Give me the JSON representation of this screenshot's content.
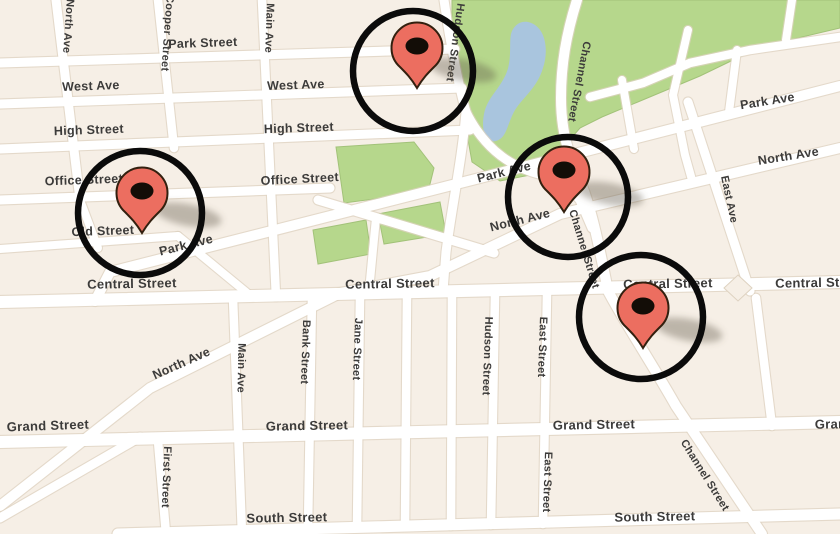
{
  "map": {
    "title": "street map with four highlighted location markers",
    "colors": {
      "block": "#f6efe6",
      "road": "#ffffff",
      "road_edge": "#ded2c0",
      "park_green": "#b6d78c",
      "water_blue": "#a9c5de",
      "label_text": "#3c3b3a",
      "pin_red": "#ec6e60",
      "pin_outline": "#33200f",
      "pin_hole": "#130d07",
      "ring_black": "#0b0b0b"
    },
    "street_labels": [
      {
        "text": "Park Street",
        "x": 203,
        "y": 47,
        "rot": -2,
        "size": 12.5
      },
      {
        "text": "West Ave",
        "x": 91,
        "y": 90,
        "rot": -2,
        "size": 12.5
      },
      {
        "text": "West Ave",
        "x": 296,
        "y": 89,
        "rot": -2,
        "size": 12.5
      },
      {
        "text": "High Street",
        "x": 89,
        "y": 134,
        "rot": -2,
        "size": 12.5
      },
      {
        "text": "High Street",
        "x": 299,
        "y": 132,
        "rot": -2,
        "size": 12.5
      },
      {
        "text": "Office Street",
        "x": 84,
        "y": 184,
        "rot": -2,
        "size": 12.5
      },
      {
        "text": "Office Street",
        "x": 300,
        "y": 183,
        "rot": -3,
        "size": 12.5
      },
      {
        "text": "Old Street",
        "x": 103,
        "y": 235,
        "rot": -2,
        "size": 12.5
      },
      {
        "text": "Central Street",
        "x": 132,
        "y": 288,
        "rot": -1,
        "size": 13
      },
      {
        "text": "Central Street",
        "x": 390,
        "y": 288,
        "rot": -1,
        "size": 13
      },
      {
        "text": "Central Street",
        "x": 668,
        "y": 288,
        "rot": -1,
        "size": 13
      },
      {
        "text": "Central Street",
        "x": 820,
        "y": 287,
        "rot": -1,
        "size": 13
      },
      {
        "text": "Grand Street",
        "x": 48,
        "y": 430,
        "rot": -2,
        "size": 13
      },
      {
        "text": "Grand Street",
        "x": 307,
        "y": 430,
        "rot": -1,
        "size": 13
      },
      {
        "text": "Grand Street",
        "x": 594,
        "y": 429,
        "rot": -1,
        "size": 13
      },
      {
        "text": "Grand Street",
        "x": 856,
        "y": 428,
        "rot": -1,
        "size": 13
      },
      {
        "text": "South Street",
        "x": 287,
        "y": 522,
        "rot": -1,
        "size": 13
      },
      {
        "text": "South Street",
        "x": 655,
        "y": 521,
        "rot": -1,
        "size": 13
      },
      {
        "text": "Park Ave",
        "x": 768,
        "y": 105,
        "rot": -9,
        "size": 12.5
      },
      {
        "text": "North Ave",
        "x": 789,
        "y": 160,
        "rot": -9,
        "size": 12.5
      },
      {
        "text": "Park Ave",
        "x": 505,
        "y": 176,
        "rot": -14,
        "size": 12.5
      },
      {
        "text": "North Ave",
        "x": 521,
        "y": 224,
        "rot": -14,
        "size": 12.5
      },
      {
        "text": "Park Ave",
        "x": 187,
        "y": 249,
        "rot": -14,
        "size": 12.5
      },
      {
        "text": "North Ave",
        "x": 183,
        "y": 367,
        "rot": -24,
        "size": 12.5
      },
      {
        "text": "North Ave",
        "x": 65,
        "y": 26,
        "rot": 94,
        "size": 11
      },
      {
        "text": "Cooper Street",
        "x": 164,
        "y": 33,
        "rot": 94,
        "size": 11
      },
      {
        "text": "Main Ave",
        "x": 266,
        "y": 28,
        "rot": 92,
        "size": 11
      },
      {
        "text": "Hudson Street",
        "x": 452,
        "y": 42,
        "rot": 98,
        "size": 11
      },
      {
        "text": "Channel Street",
        "x": 576,
        "y": 81,
        "rot": 101,
        "size": 11
      },
      {
        "text": "East Ave",
        "x": 726,
        "y": 200,
        "rot": 78,
        "size": 11
      },
      {
        "text": "Channel Street",
        "x": 581,
        "y": 250,
        "rot": 73,
        "size": 11
      },
      {
        "text": "Bank Street",
        "x": 302,
        "y": 352,
        "rot": 92,
        "size": 11
      },
      {
        "text": "Jane Street",
        "x": 354,
        "y": 349,
        "rot": 92,
        "size": 11
      },
      {
        "text": "Hudson Street",
        "x": 484,
        "y": 356,
        "rot": 92,
        "size": 11
      },
      {
        "text": "East Street",
        "x": 539,
        "y": 347,
        "rot": 92,
        "size": 11
      },
      {
        "text": "East Street",
        "x": 544,
        "y": 482,
        "rot": 92,
        "size": 11
      },
      {
        "text": "First Street",
        "x": 163,
        "y": 477,
        "rot": 92,
        "size": 11
      },
      {
        "text": "Main Ave",
        "x": 238,
        "y": 368,
        "rot": 91,
        "size": 11
      },
      {
        "text": "Channel Street",
        "x": 702,
        "y": 477,
        "rot": 58,
        "size": 11
      }
    ],
    "markers": [
      {
        "id": "marker-1",
        "ring_cx": 413,
        "ring_cy": 71,
        "ring_r": 60,
        "tip_x": 417,
        "tip_y": 88
      },
      {
        "id": "marker-2",
        "ring_cx": 140,
        "ring_cy": 213,
        "ring_r": 62,
        "tip_x": 142,
        "tip_y": 233
      },
      {
        "id": "marker-3",
        "ring_cx": 568,
        "ring_cy": 197,
        "ring_r": 60,
        "tip_x": 564,
        "tip_y": 212
      },
      {
        "id": "marker-4",
        "ring_cx": 641,
        "ring_cy": 317,
        "ring_r": 62,
        "tip_x": 643,
        "tip_y": 348
      }
    ]
  }
}
